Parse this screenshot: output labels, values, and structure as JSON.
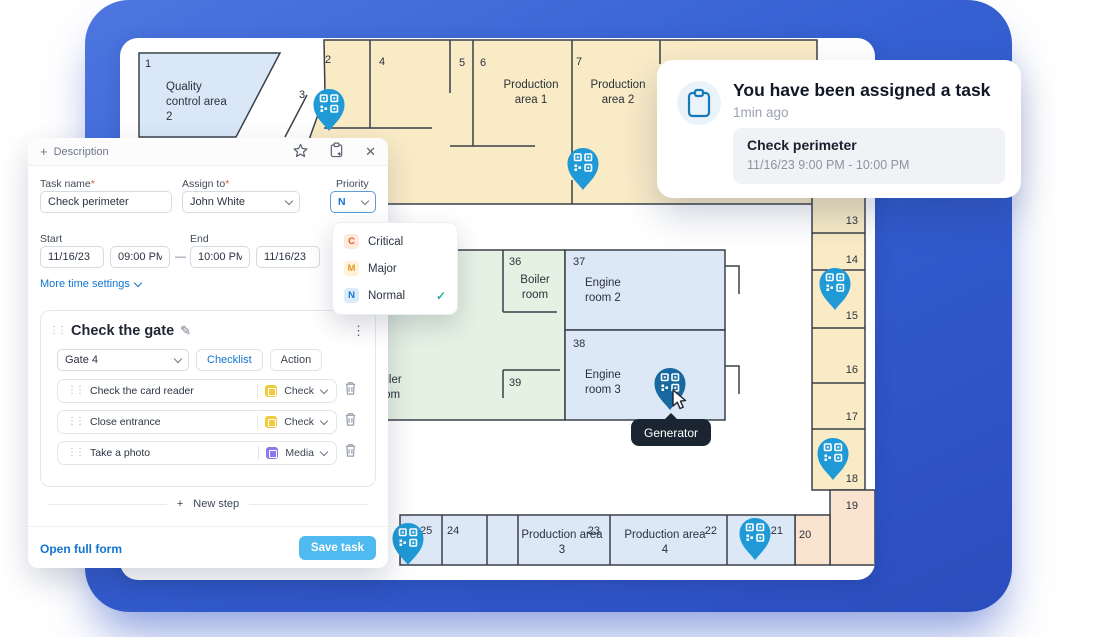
{
  "theme": {
    "frame_blue": "#3560d2",
    "pin_blue": "#1f9ad6",
    "pin_blue_hover": "#17699f",
    "accent_blue": "#1274d2",
    "save_button_blue": "#4fbaef",
    "room_yellow": "#f9ebc6",
    "room_blue": "#dde8f7",
    "room_green": "#e5f1e3",
    "room_peach": "#fae4d0",
    "wall_color": "#3a4049",
    "tooltip_bg": "#1b2531"
  },
  "icons": {
    "plus": "+",
    "close": "✕",
    "kebab": "⋮",
    "drag": "⋮⋮",
    "pencil": "✎",
    "check": "✓"
  },
  "notification": {
    "title": "You have been assigned a task",
    "time_ago": "1min ago",
    "task_name": "Check perimeter",
    "task_time": "11/16/23 9:00 PM - 10:00 PM"
  },
  "form": {
    "required_mark": "*",
    "header": {
      "title": "Description"
    },
    "task_name": {
      "label": "Task name",
      "value": "Check perimeter"
    },
    "assign_to": {
      "label": "Assign to",
      "value": "John White"
    },
    "priority": {
      "label": "Priority",
      "value": "N"
    },
    "schedule": {
      "start_label": "Start",
      "start_date": "11/16/23",
      "start_time": "09:00 PM",
      "separator": "—",
      "end_label": "End",
      "end_time": "10:00 PM",
      "end_date": "11/16/23",
      "more_link": "More time settings"
    },
    "priority_menu": {
      "items": [
        {
          "key": "C",
          "label": "Critical"
        },
        {
          "key": "M",
          "label": "Major"
        },
        {
          "key": "N",
          "label": "Normal"
        }
      ],
      "selected": "Normal"
    },
    "step": {
      "title": "Check the gate",
      "location": "Gate 4",
      "checklist_btn": "Checklist",
      "action_btn": "Action",
      "items": [
        {
          "label": "Check the card reader",
          "type": "Check"
        },
        {
          "label": "Close entrance",
          "type": "Check"
        },
        {
          "label": "Take a photo",
          "type": "Media"
        }
      ]
    },
    "new_step": "New step",
    "open_full_form": "Open full form",
    "save_task": "Save task"
  },
  "map": {
    "tooltip": "Generator",
    "rooms": {
      "r1": {
        "num": "1",
        "name": "Quality control area 2"
      },
      "r2": {
        "num": "2"
      },
      "r3": {
        "num": "3"
      },
      "r4": {
        "num": "4"
      },
      "r5": {
        "num": "5"
      },
      "r6": {
        "num": "6",
        "name": "Production area 1"
      },
      "r7": {
        "num": "7",
        "name": "Production area 2"
      },
      "r13": {
        "num": "13"
      },
      "r14": {
        "num": "14"
      },
      "r15": {
        "num": "15"
      },
      "r16": {
        "num": "16"
      },
      "r17": {
        "num": "17"
      },
      "r18": {
        "num": "18"
      },
      "r19": {
        "num": "19"
      },
      "r20": {
        "num": "20"
      },
      "r21": {
        "num": "21"
      },
      "r22": {
        "num": "22",
        "name": "Production area 4"
      },
      "r23": {
        "num": "23",
        "name": "Production area 3"
      },
      "r24": {
        "num": "24"
      },
      "r25": {
        "num": "25"
      },
      "r36": {
        "num": "36",
        "name": "Boiler room"
      },
      "r37": {
        "num": "37",
        "name": "Engine room 2"
      },
      "r38": {
        "num": "38",
        "name": "Engine room 3"
      },
      "r39": {
        "num": "39"
      },
      "partial_boiler": {
        "name": "Boiler room"
      }
    }
  }
}
